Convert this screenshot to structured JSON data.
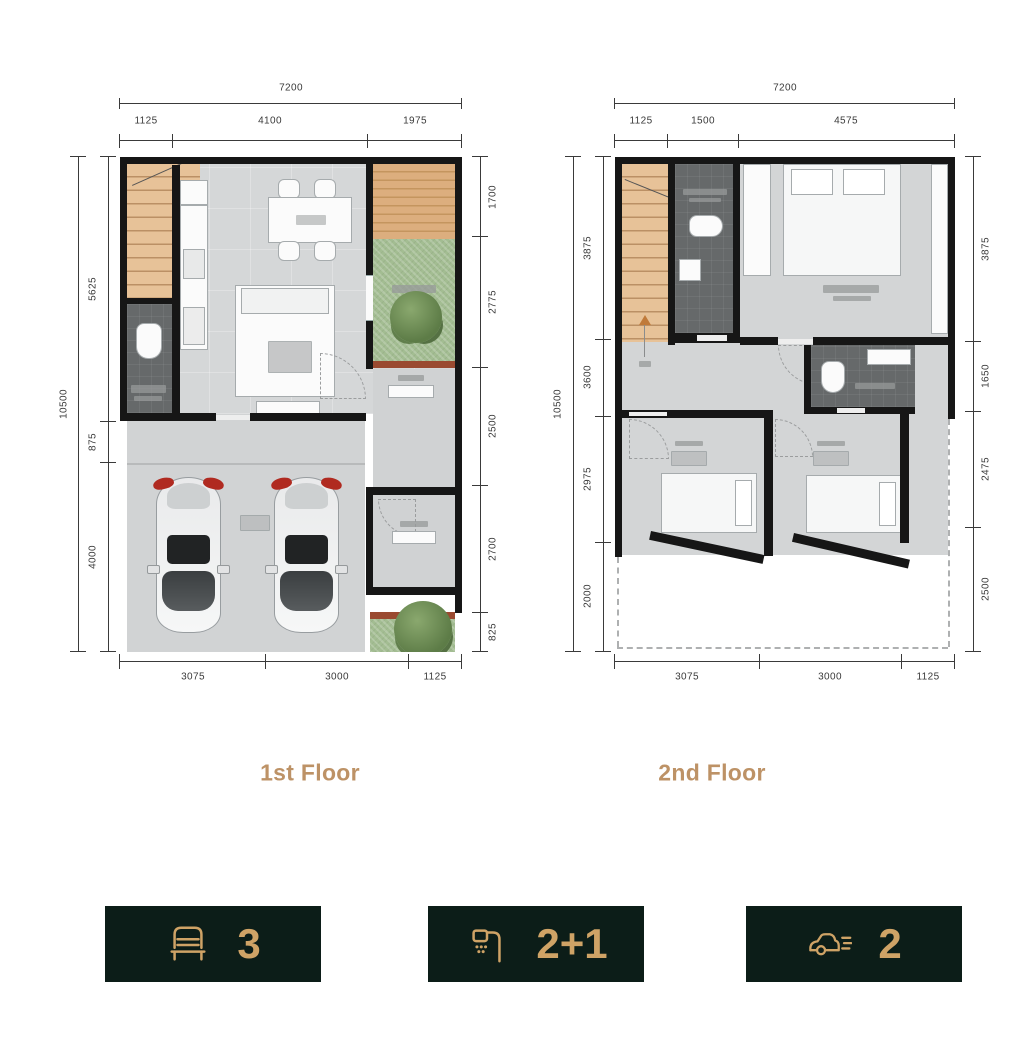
{
  "floors": [
    {
      "label": "1st Floor",
      "dims": {
        "top_total": "7200",
        "top_segments": [
          "1125",
          "4100",
          "1975"
        ],
        "left_total": "10500",
        "left_segments": [
          "5625",
          "875",
          "4000"
        ],
        "right_segments": [
          "1700",
          "2775",
          "2500",
          "2700",
          "825"
        ],
        "bottom_segments": [
          "3075",
          "3000",
          "1125"
        ]
      }
    },
    {
      "label": "2nd Floor",
      "dims": {
        "top_total": "7200",
        "top_segments": [
          "1125",
          "1500",
          "4575"
        ],
        "left_total": "10500",
        "left_segments": [
          "3875",
          "3600",
          "2975",
          "2000"
        ],
        "right_segments": [
          "3875",
          "1650",
          "2475",
          "2500"
        ],
        "bottom_segments": [
          "3075",
          "3000",
          "1125"
        ]
      }
    }
  ],
  "badges": [
    {
      "name": "bedrooms",
      "icon": "bed-icon",
      "value": "3"
    },
    {
      "name": "bathrooms",
      "icon": "shower-icon",
      "value": "2+1"
    },
    {
      "name": "carports",
      "icon": "car-icon",
      "value": "2"
    }
  ],
  "colors": {
    "accent_gold": "#cfa366",
    "badge_background": "#0c1d18",
    "floor_label": "#bd9266",
    "wall": "#161616",
    "stairs": "#e7c298",
    "garden": "#a3bd92",
    "deck": "#dcae7e",
    "bathroom": "#66696a"
  }
}
